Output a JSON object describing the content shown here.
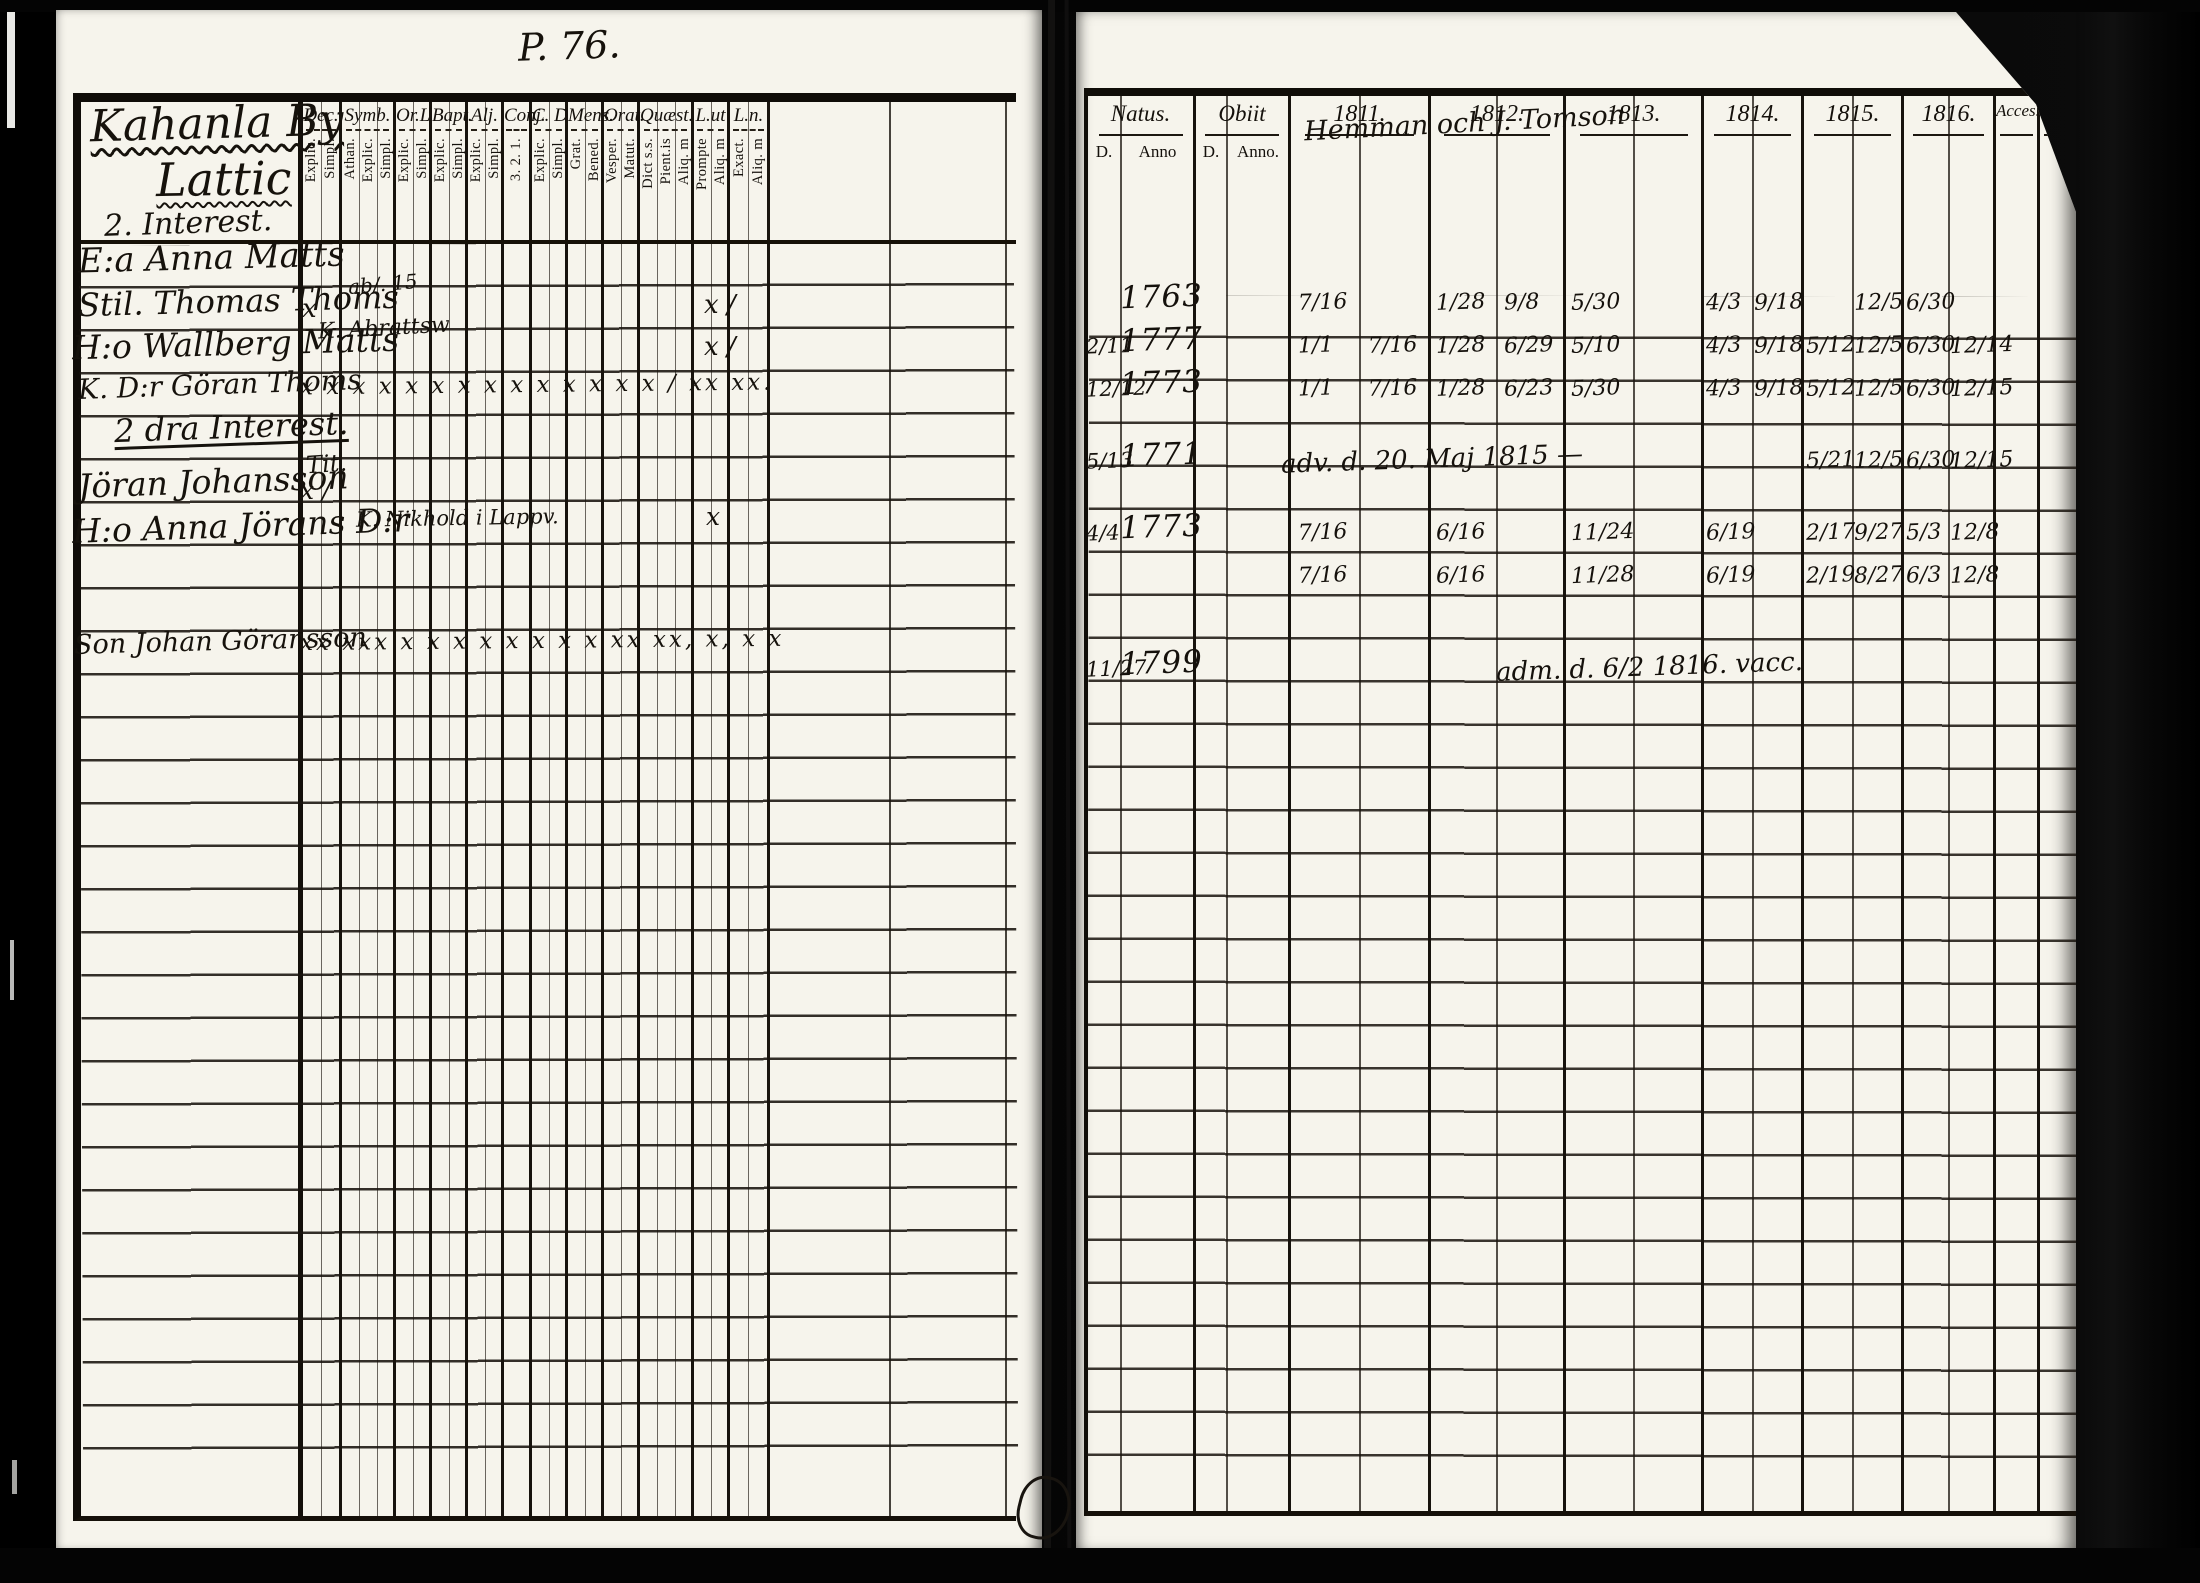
{
  "scan": {
    "page_number": "P. 76.",
    "left_page": {
      "title": "Kahanla By",
      "subtitle": "Lattic",
      "section_1": "2. Interest.",
      "section_2": "2 dra Interest.",
      "columns": [
        {
          "label": "Dec.",
          "subs": [
            "Explic.",
            "Simpl."
          ]
        },
        {
          "label": "Symb.",
          "subs": [
            "Athan.",
            "Explic.",
            "Simpl."
          ]
        },
        {
          "label": "Or.L",
          "subs": [
            "Explic.",
            "Simpl."
          ]
        },
        {
          "label": "Bapt.",
          "subs": [
            "Explic.",
            "Simpl."
          ]
        },
        {
          "label": "Alj.",
          "subs": [
            "Explic.",
            "Simpl."
          ]
        },
        {
          "label": "Conj.",
          "subs": [
            "3. 2. 1."
          ]
        },
        {
          "label": "C. D",
          "subs": [
            "Explic.",
            "Simpl."
          ]
        },
        {
          "label": "Mens.",
          "subs": [
            "Grat.",
            "Bened."
          ]
        },
        {
          "label": "Orat.",
          "subs": [
            "Vesper.",
            "Matut."
          ]
        },
        {
          "label": "Quæst.",
          "subs": [
            "Dict s.s.",
            "Pient.is",
            "Aliq. m"
          ]
        },
        {
          "label": "L.ut",
          "subs": [
            "Prompte",
            "Aliq. m"
          ]
        },
        {
          "label": "L.n.",
          "subs": [
            "Exact.",
            "Aliq. m"
          ]
        }
      ],
      "rows": [
        {
          "prefix": "E:a",
          "name": "Anna Matts"
        },
        {
          "prefix": "Stil.",
          "name": "Thomas Thoms",
          "note": "ab/. 15",
          "mark_dec": "x",
          "mark_ln": "x /"
        },
        {
          "prefix": "H:o",
          "name": "Wallberg Matts",
          "note": "K. Abrattsw",
          "mark_ln": "x /"
        },
        {
          "prefix": "K. D:r",
          "name": "Göran Thoms",
          "marks": "x x   x x   x x x x   x x x   x x   x /       xx   xx."
        },
        {
          "prefix": "",
          "name": "Jöran Johansson",
          "note": "Tit.",
          "mark_dec": "x /"
        },
        {
          "prefix": "H:o",
          "name": "Anna Jörans D:r",
          "note": "K. Nikhold i Lappv.",
          "mark_ln": "x"
        },
        {
          "prefix": "Son",
          "name": "Johan Göransson",
          "marks": "xx  xxx  x x    x  x    x x   x x   xx   xx,  x,    x x"
        }
      ]
    },
    "right_page": {
      "natus_label": "Natus.",
      "natus_sub_d": "D.",
      "natus_sub_anno": "Anno",
      "obiit_label": "Obiit",
      "obiit_sub_d": "D.",
      "obiit_sub_anno": "Anno.",
      "years": [
        "1811.",
        "1812.",
        "1813.",
        "1814.",
        "1815.",
        "1816."
      ],
      "acces_label": "Acces.",
      "abiit_label": "Abiit.",
      "header_note": "Hemman och J. Tomson",
      "rows": [
        {
          "natus_anno": "1763",
          "y11a": "7/16",
          "y12a": "1/28",
          "y12b": "9/8",
          "y13a": "5/30",
          "y14a": "4/3",
          "y14b": "9/18",
          "y15b": "12/5",
          "y16a": "6/30"
        },
        {
          "natus_d": "2/11",
          "natus_anno": "1777",
          "y11a": "1/1",
          "y11b": "7/16",
          "y12a": "1/28",
          "y12b": "6/29",
          "y13a": "5/10",
          "y14a": "4/3",
          "y14b": "9/18",
          "y15a": "5/12",
          "y15b": "12/5",
          "y16a": "6/30",
          "y16b": "12/14"
        },
        {
          "natus_d": "12/12",
          "natus_anno": "1773",
          "y11a": "1/1",
          "y11b": "7/16",
          "y12a": "1/28",
          "y12b": "6/23",
          "y13a": "5/30",
          "y14a": "4/3",
          "y14b": "9/18",
          "y15a": "5/12",
          "y15b": "12/5",
          "y16a": "6/30",
          "y16b": "12/15"
        },
        {
          "natus_d": "5/13",
          "natus_anno": "1771",
          "note": "adv. d. 20. Maj 1815 —",
          "y15a": "5/21",
          "y15b": "12/5",
          "y16a": "6/30",
          "y16b": "12/15"
        },
        {
          "natus_d": "4/4",
          "natus_anno": "1773",
          "y11a": "7/16",
          "y12a": "6/16",
          "y13a": "11/24",
          "y14a": "6/19",
          "y15a": "2/17",
          "y15b": "9/27",
          "y16a": "5/3",
          "y16b": "12/8"
        },
        {
          "y11a": "7/16",
          "y12a": "6/16",
          "y13a": "11/28",
          "y14a": "6/19",
          "y15a": "2/19",
          "y15b": "8/27",
          "y16a": "6/3",
          "y16b": "12/8"
        },
        {
          "natus_d": "11/27",
          "natus_anno": "1799",
          "note": "adm. d. 6/2 1816.  vacc."
        }
      ]
    }
  }
}
